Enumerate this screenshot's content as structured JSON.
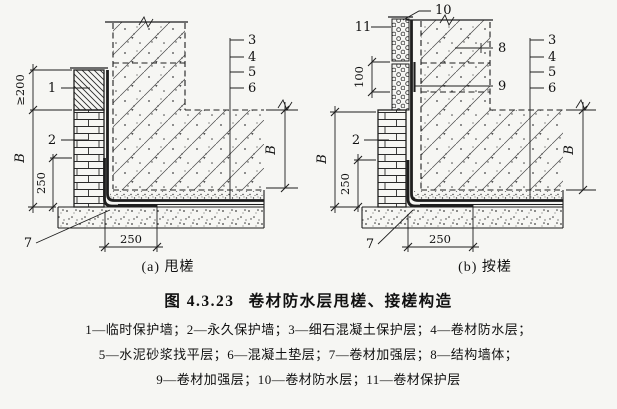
{
  "figure": {
    "number": "图 4.3.23",
    "title": "卷材防水层甩槎、接槎构造"
  },
  "legend": {
    "lines": [
      "1—临时保护墙；2—永久保护墙；3—细石混凝土保护层；4—卷材防水层；",
      "5—水泥砂浆找平层；6—混凝土垫层；7—卷材加强层；8—结构墙体；",
      "9—卷材加强层；10—卷材防水层；11—卷材保护层"
    ]
  },
  "diagram_a": {
    "caption": "(a) 甩槎",
    "callouts": {
      "c1": "1",
      "c2": "2",
      "c3": "3",
      "c4": "4",
      "c5": "5",
      "c6": "6",
      "c7": "7"
    },
    "dims": {
      "above_ground": "≥200",
      "buried_depth": "B",
      "corner_upturn": "250",
      "strip_width": "250",
      "right_depth": "B"
    }
  },
  "diagram_b": {
    "caption": "(b) 按槎",
    "callouts": {
      "c2": "2",
      "c3": "3",
      "c4": "4",
      "c5": "5",
      "c6": "6",
      "c7": "7",
      "c8": "8",
      "c9": "9",
      "c10": "10",
      "c11": "11"
    },
    "dims": {
      "overlap": "100",
      "buried_depth": "B",
      "corner_upturn": "250",
      "strip_width": "250",
      "right_depth": "B"
    }
  }
}
